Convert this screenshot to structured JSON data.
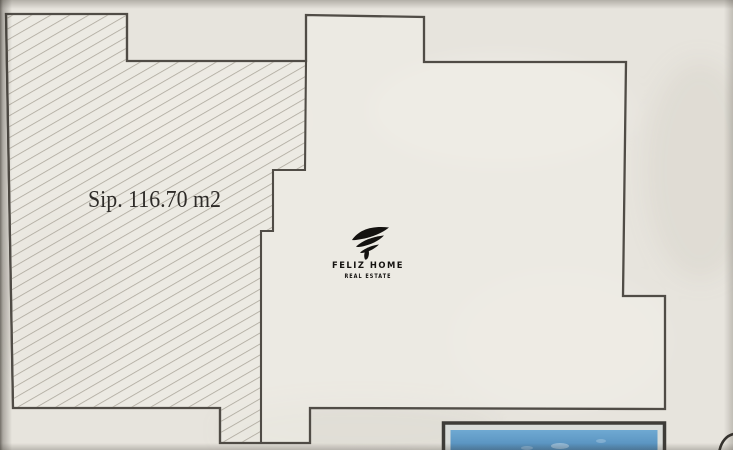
{
  "plan": {
    "area_label": "Sip. 116.70 m2"
  },
  "logo": {
    "mark_icon": "flame-swoosh-f-icon",
    "title": "FELIZ HOME",
    "subtitle": "REAL ESTATE"
  },
  "colors": {
    "paper": "#e7e4dd",
    "plan_fill": "#f1eee7",
    "outline": "#504c46",
    "hatch_line": "#aba69b",
    "area_text": "#2e2b28",
    "logo_ink": "#141210",
    "pool_water_top": "#6fa9d2",
    "pool_water_bottom": "#4781b1",
    "pool_border": "#3e3c38",
    "pool_mat": "#d9dcd9"
  }
}
